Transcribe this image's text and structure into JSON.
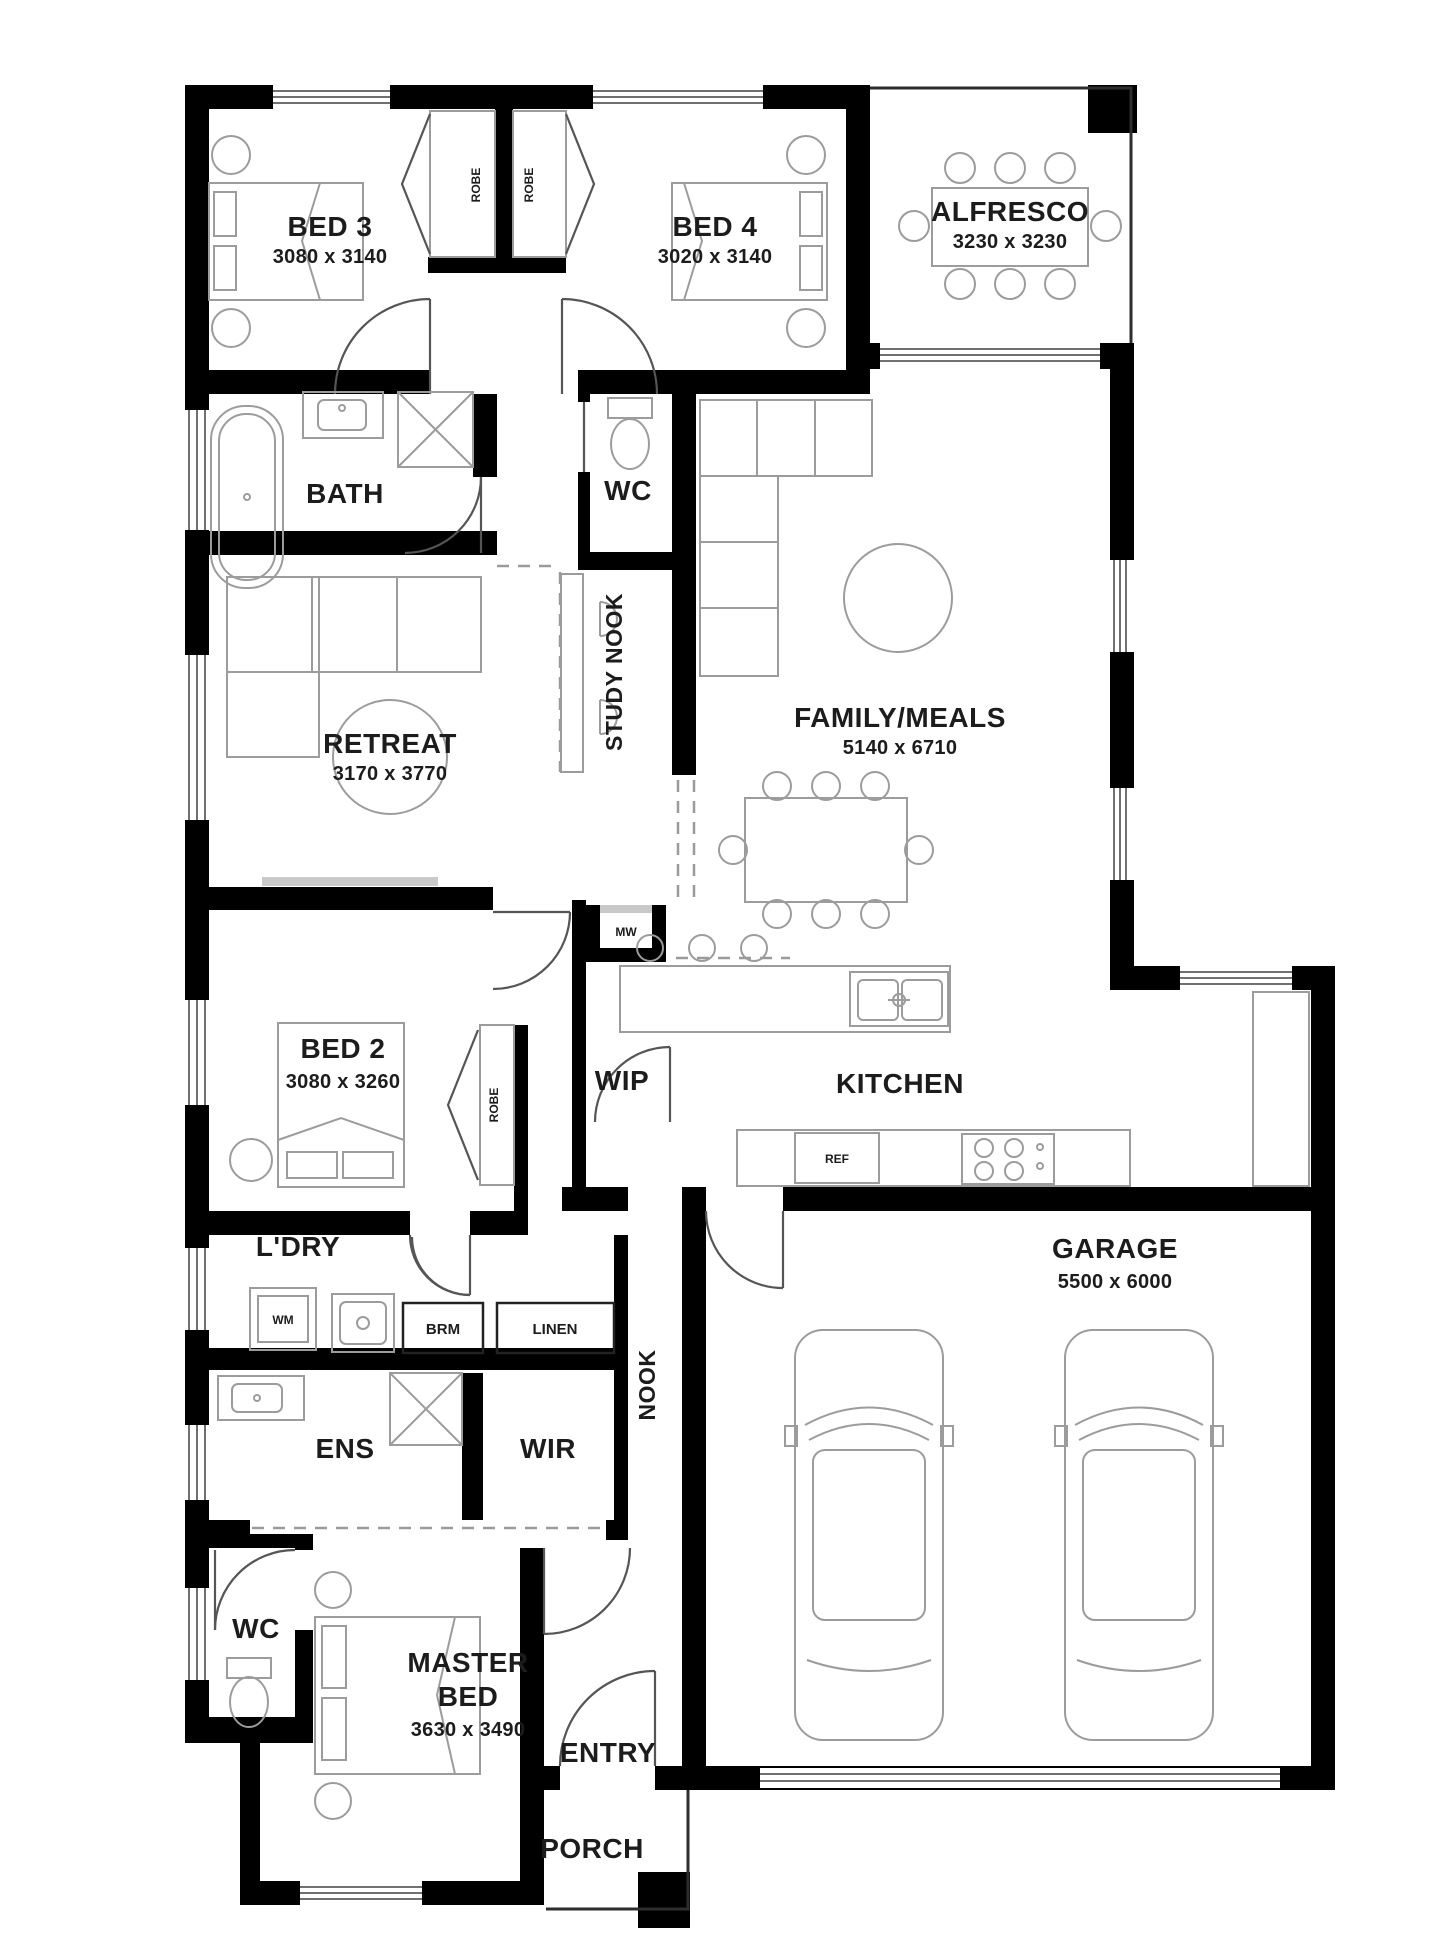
{
  "plan_type": "house-floor-plan",
  "style": {
    "wall_color": "#000000",
    "furniture_color": "#9c9c9c",
    "text_color": "#1c1c1c",
    "door_color": "#555555",
    "background": "#ffffff"
  },
  "rooms": {
    "bed3": {
      "label": "BED 3",
      "dims": "3080 x 3140"
    },
    "bed4": {
      "label": "BED 4",
      "dims": "3020 x 3140"
    },
    "alfresco": {
      "label": "ALFRESCO",
      "dims": "3230 x 3230"
    },
    "bath": {
      "label": "BATH"
    },
    "wc_upper": {
      "label": "WC"
    },
    "study_nook": {
      "label": "STUDY NOOK"
    },
    "retreat": {
      "label": "RETREAT",
      "dims": "3170 x 3770"
    },
    "family": {
      "label": "FAMILY/MEALS",
      "dims": "5140 x 6710"
    },
    "bed2": {
      "label": "BED 2",
      "dims": "3080 x 3260"
    },
    "wip": {
      "label": "WIP"
    },
    "kitchen": {
      "label": "KITCHEN"
    },
    "ldry": {
      "label": "L'DRY"
    },
    "nook": {
      "label": "NOOK"
    },
    "ens": {
      "label": "ENS"
    },
    "wir": {
      "label": "WIR"
    },
    "garage": {
      "label": "GARAGE",
      "dims": "5500 x 6000"
    },
    "entry": {
      "label": "ENTRY"
    },
    "wc_lower": {
      "label": "WC"
    },
    "master": {
      "lines": [
        "MASTER",
        "BED"
      ],
      "dims": "3630 x 3490"
    },
    "porch": {
      "label": "PORCH"
    }
  },
  "fixtures": {
    "robe_left": "ROBE",
    "robe_right": "ROBE",
    "robe_bed2": "ROBE",
    "brm": "BRM",
    "linen": "LINEN",
    "wm": "WM",
    "ref": "REF",
    "niche": "MW"
  }
}
